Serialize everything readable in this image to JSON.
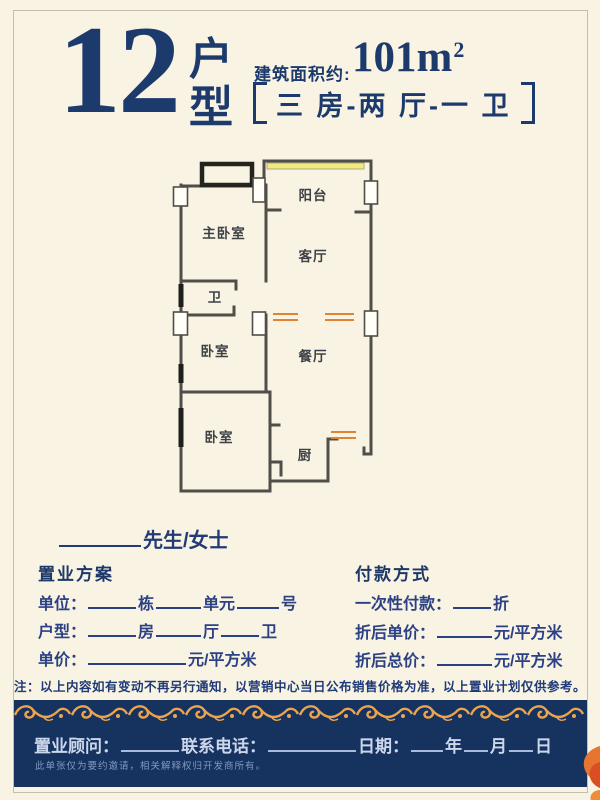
{
  "colors": {
    "background": "#f8f3e2",
    "header_navy": "#1d3a6d",
    "form_blue": "#2b4184",
    "panel_navy": "#16325e",
    "gold": "#eca44e",
    "orange_marks": "#e08434",
    "wall_gray": "#504e48",
    "balcony_window_yellow": "#f1eb7d"
  },
  "header": {
    "unit_number": "12",
    "unit_type_char1": "户",
    "unit_type_char2": "型",
    "area_label": "建筑面积约:",
    "area_value": "101m",
    "area_sup": "2",
    "layout_spec": "三 房-两 厅-一 卫"
  },
  "floorplan": {
    "rooms": {
      "balcony": "阳台",
      "master_bedroom": "主卧室",
      "living_room": "客厅",
      "bathroom": "卫",
      "bedroom2": "卧室",
      "dining_room": "餐厅",
      "bedroom3": "卧室",
      "kitchen": "厨"
    }
  },
  "greeting": {
    "label": "先生/女士"
  },
  "plan": {
    "title": "置业方案",
    "row1": {
      "label": "单位：",
      "seg1": "栋",
      "seg2": "单元",
      "seg3": "号"
    },
    "row2": {
      "label": "户型：",
      "seg1": "房",
      "seg2": "厅",
      "seg3": "卫"
    },
    "row3": {
      "label": "单价：",
      "suffix": "元/平方米"
    }
  },
  "payment": {
    "title": "付款方式",
    "row1": {
      "label": "一次性付款：",
      "suffix": "折"
    },
    "row2": {
      "label": "折后单价：",
      "suffix": "元/平方米"
    },
    "row3": {
      "label": "折后总价：",
      "suffix": "元/平方米"
    }
  },
  "note": {
    "text": "注：以上内容如有变动不再另行通知，以营销中心当日公布销售价格为准，以上置业计划仅供参考。"
  },
  "footer": {
    "consultant_label": "置业顾问：",
    "phone_label": "联系电话：",
    "date_label": "日期：",
    "year_label": "年",
    "month_label": "月",
    "day_label": "日",
    "disclaimer": "此单张仅为要约邀请，相关解释权归开发商所有。"
  }
}
